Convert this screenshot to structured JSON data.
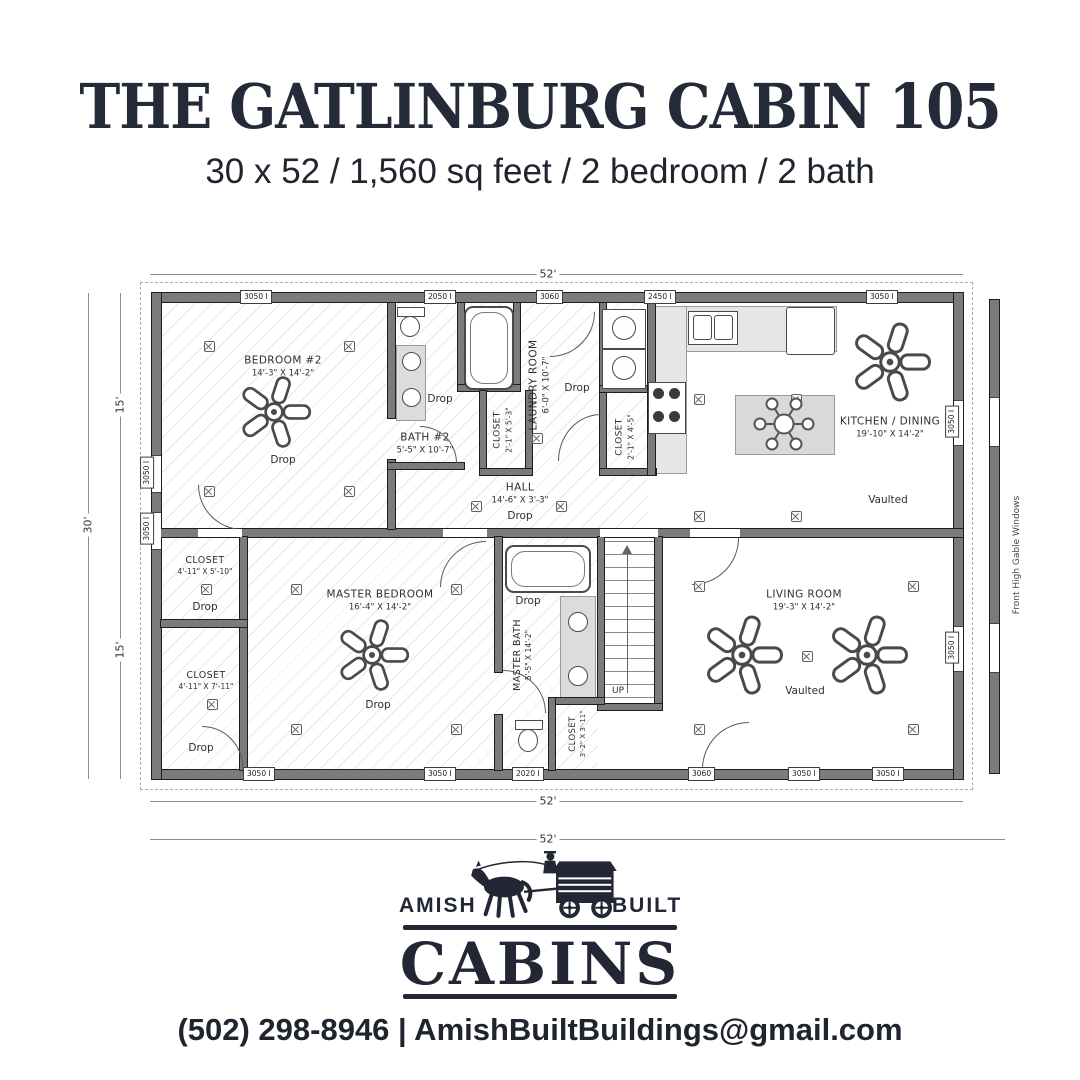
{
  "header": {
    "title": "THE GATLINBURG CABIN 105",
    "subtitle": "30 x 52 / 1,560 sq feet / 2 bedroom / 2 bath"
  },
  "plan": {
    "dim_top": "52'",
    "dim_bottom_inner": "52'",
    "dim_bottom_outer": "52'",
    "dim_left_total": "30'",
    "dim_left_upper": "15'",
    "dim_left_lower": "15'",
    "side_note": "Front High Gable Windows",
    "up_label": "UP",
    "rooms": {
      "bedroom2": {
        "name": "BEDROOM #2",
        "dims": "14'-3\" X 14'-2\"",
        "note": "Drop"
      },
      "bath2": {
        "name": "BATH #2",
        "dims": "5'-5\" X 10'-7\"",
        "note": "Drop"
      },
      "laundry": {
        "name": "LAUNDRY ROOM",
        "dims": "6'-0\" X 10'-7\"",
        "note": "Drop"
      },
      "closet_bath": {
        "name": "CLOSET",
        "dims": "2'-1\" X 5'-3\""
      },
      "closet_kitchen": {
        "name": "CLOSET",
        "dims": "2'-1\" X 4'-5\""
      },
      "hall": {
        "name": "HALL",
        "dims": "14'-6\" X 3'-3\"",
        "note": "Drop"
      },
      "kitchen": {
        "name": "KITCHEN / DINING",
        "dims": "19'-10\" X 14'-2\"",
        "note": "Vaulted"
      },
      "closet_master1": {
        "name": "CLOSET",
        "dims": "4'-11\" X 5'-10\"",
        "note": "Drop"
      },
      "closet_master2": {
        "name": "CLOSET",
        "dims": "4'-11\" X 7'-11\"",
        "note": "Drop"
      },
      "master_bedroom": {
        "name": "MASTER BEDROOM",
        "dims": "16'-4\" X 14'-2\"",
        "note": "Drop"
      },
      "master_bath": {
        "name": "MASTER BATH",
        "dims": "5'-5\" X 14'-2\"",
        "note": "Drop"
      },
      "closet_stairs": {
        "name": "CLOSET",
        "dims": "3'-2\" X 3'-11\""
      },
      "living": {
        "name": "LIVING ROOM",
        "dims": "19'-3\" X 14'-2\"",
        "note": "Vaulted"
      }
    },
    "windows_top": [
      "3050 I",
      "2050 I",
      "3060",
      "2450 I",
      "3050 I"
    ],
    "windows_bottom": [
      "3050 I",
      "3050 I",
      "2020 I",
      "3060",
      "3050 I",
      "3050 I"
    ],
    "windows_left": [
      "3050 I",
      "3050 I"
    ],
    "windows_right": [
      "3050 I",
      "3050 I"
    ]
  },
  "logo": {
    "amish": "AMISH",
    "built": "BUILT",
    "cabins": "CABINS"
  },
  "footer": {
    "contact": "(502) 298-8946 | AmishBuiltBuildings@gmail.com"
  }
}
